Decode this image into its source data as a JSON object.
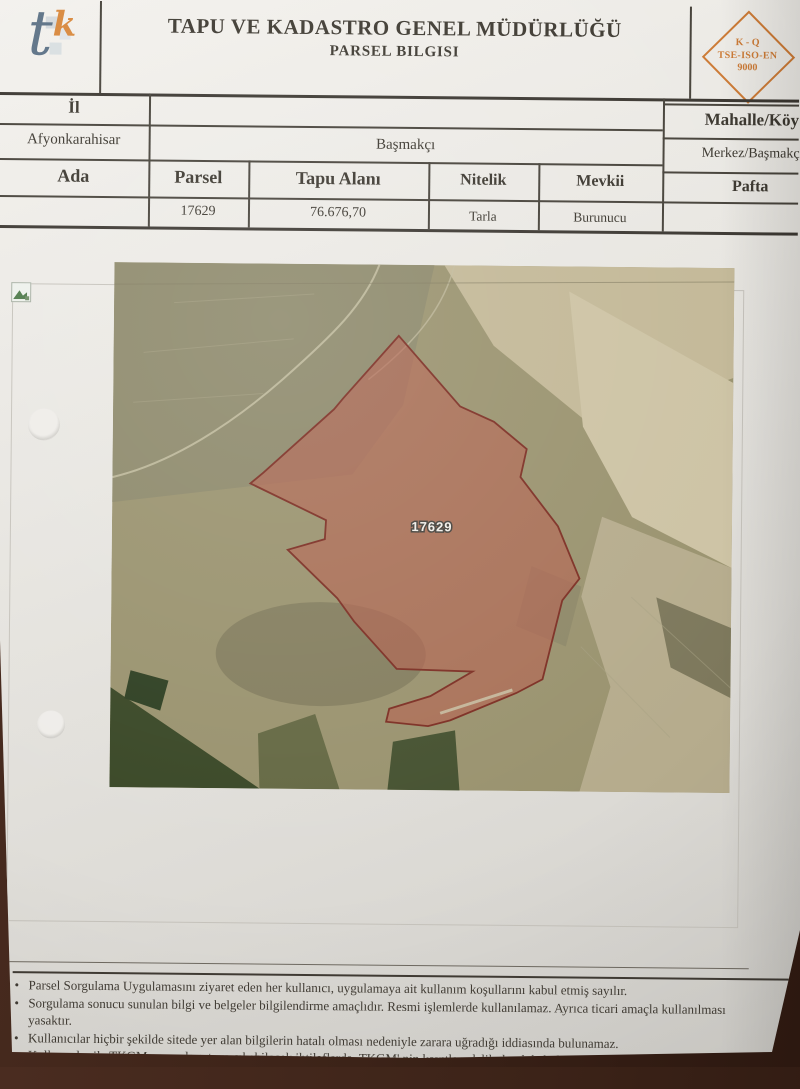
{
  "header": {
    "title": "TAPU VE KADASTRO GENEL MÜDÜRLÜĞÜ",
    "subtitle": "PARSEL BILGISI",
    "logo": {
      "letter_t": "t",
      "letter_k": "k"
    },
    "badge": {
      "line1": "K - Q",
      "line2": "TSE-ISO-EN",
      "line3": "9000"
    }
  },
  "info_table": {
    "row1": {
      "il_label": "İl",
      "mahalle_koy_label": "Mahalle/Köy"
    },
    "row2": {
      "il_value": "Afyonkarahisar",
      "ilce_value": "Başmakçı",
      "mahalle_koy_value": "Merkez/Başmakçı"
    },
    "columns": [
      "Ada",
      "Parsel",
      "Tapu Alanı",
      "Nitelik",
      "Mevkii",
      "Pafta"
    ],
    "values": {
      "ada": "",
      "parsel": "17629",
      "tapu_alani": "76.676,70",
      "nitelik": "Tarla",
      "mevkii": "Burunucu",
      "pafta": ""
    }
  },
  "map": {
    "parcel_label": "17629",
    "parcel_fill": "#b4604e",
    "parcel_stroke": "#7d2f24"
  },
  "footer": {
    "bullets": [
      "Parsel Sorgulama Uygulamasını ziyaret eden her kullanıcı, uygulamaya ait kullanım koşullarını kabul etmiş sayılır.",
      "Sorgulama sonucu sunulan bilgi ve belgeler bilgilendirme amaçlıdır. Resmi işlemlerde kullanılamaz. Ayrıca ticari amaçla kullanılması yasaktır.",
      "Kullanıcılar hiçbir şekilde sitede yer alan bilgilerin hatalı olması nedeniyle zarara uğradığı iddiasında bulunamaz.",
      "Kullanıcılar ile TKGM arasında ortaya çıkabilecek ihtilaflarda, TKGM' nin kayıtları delil olarak kabul edilecektir.",
      "Tüm Hakları Saklıdır."
    ]
  },
  "colors": {
    "badge_orange": "#cc7a35",
    "background_brown": "#3c2318",
    "table_line": "#46423a"
  }
}
